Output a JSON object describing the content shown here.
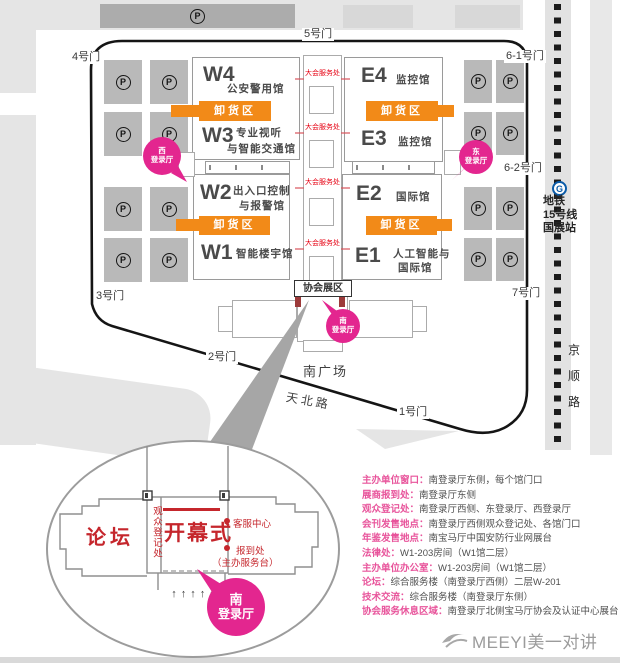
{
  "map": {
    "gates": [
      {
        "label": "5号门"
      },
      {
        "label": "4号门"
      },
      {
        "label": "6-1号门"
      },
      {
        "label": "6-2号门"
      },
      {
        "label": "7号门"
      },
      {
        "label": "3号门"
      },
      {
        "label": "2号门"
      },
      {
        "label": "1号门"
      }
    ],
    "halls": {
      "w4": {
        "code": "W4",
        "name": "公安警用馆"
      },
      "w3": {
        "code": "W3",
        "name1": "专业视听",
        "name2": "与智能交通馆"
      },
      "w2": {
        "code": "W2",
        "name1": "出入口控制",
        "name2": "与报警馆"
      },
      "w1": {
        "code": "W1",
        "name": "智能楼宇馆"
      },
      "e4": {
        "code": "E4",
        "name": "监控馆"
      },
      "e3": {
        "code": "E3",
        "name": "监控馆"
      },
      "e2": {
        "code": "E2",
        "name": "国际馆"
      },
      "e1": {
        "code": "E1",
        "name1": "人工智能与",
        "name2": "国际馆"
      }
    },
    "unloading_label": "卸货区",
    "service_label": "大会服务处",
    "association_zone_label": "协会展区",
    "registration": {
      "west": [
        "西",
        "登录厅"
      ],
      "east": [
        "东",
        "登录厅"
      ],
      "south": [
        "南",
        "登录厅"
      ]
    },
    "south_square": "南广场",
    "road_tianbei": "天北路",
    "road_jingshun": [
      "京",
      "顺",
      "路"
    ],
    "metro": {
      "icon": "G",
      "line1": "地铁",
      "line2": "15号线",
      "line3": "国展站"
    },
    "parking_symbol": "P",
    "parking": {
      "left": {
        "cols": [
          104,
          150
        ],
        "rows": [
          60,
          112,
          187,
          238
        ],
        "w": 38,
        "h": 44
      },
      "right": {
        "cols": [
          464,
          496
        ],
        "rows": [
          60,
          112,
          187,
          238
        ],
        "w": 28,
        "h": 43
      }
    }
  },
  "detail": {
    "forum": "论坛",
    "audience_registration": "观众登记处",
    "opening_ceremony": "开幕式",
    "service_center": "客服中心",
    "checkin": "报到处",
    "checkin_sub": "（主办服务台）",
    "south_hall": [
      "南",
      "登录厅"
    ],
    "arrows": "↑↑↑↑↑"
  },
  "info_list": [
    {
      "label": "主办单位窗口：",
      "value": "南登录厅东侧，每个馆门口"
    },
    {
      "label": "展商报到处：",
      "value": "南登录厅东侧"
    },
    {
      "label": "观众登记处：",
      "value": "南登录厅西侧、东登录厅、西登录厅"
    },
    {
      "label": "会刊发售地点：",
      "value": "南登录厅西侧观众登记处、各馆门口"
    },
    {
      "label": "年鉴发售地点：",
      "value": "南宝马厅中国安防行业网展台"
    },
    {
      "label": "法律处：",
      "value": "W1-203房间（W1馆二层）"
    },
    {
      "label": "主办单位办公室：",
      "value": "W1-203房间（W1馆二层）"
    },
    {
      "label": "论坛：",
      "value": "综合服务楼（南登录厅西侧）二层W-201"
    },
    {
      "label": "技术交流：",
      "value": "综合服务楼（南登录厅东侧）"
    },
    {
      "label": "协会服务休息区域：",
      "value": "南登录厅北侧宝马厅协会及认证中心展台"
    }
  ],
  "footer": {
    "brand": "MEEYI美一对讲"
  },
  "colors": {
    "accent_pink": "#E3268F",
    "accent_orange": "#F28A18",
    "label_pink": "#E8549B",
    "red": "#C5262C",
    "service_red": "#E60012",
    "metro_blue": "#0A5BA8"
  }
}
